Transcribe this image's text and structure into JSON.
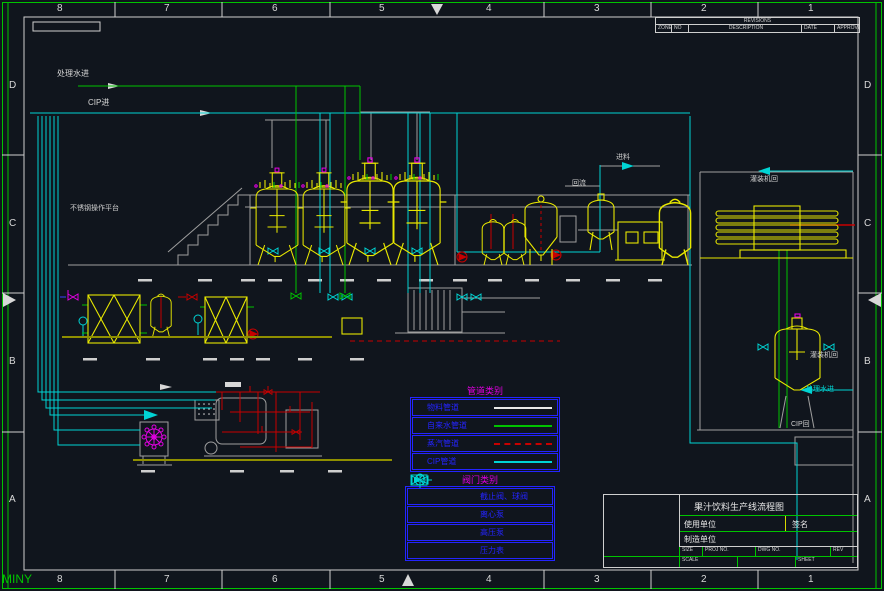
{
  "colors": {
    "background": "#10151d",
    "frame_green": "#00c400",
    "line_white": "#d8d8d8",
    "cip_cyan": "#00d4d4",
    "water_green": "#00c400",
    "steam_red": "#c80000",
    "equipment_yellow": "#e8e800",
    "legend_blue": "#2424ff",
    "accent_magenta": "#e000e0"
  },
  "border": {
    "zones": [
      "8",
      "7",
      "6",
      "5",
      "4",
      "3",
      "2",
      "1"
    ],
    "rows": [
      "D",
      "C",
      "B",
      "A"
    ]
  },
  "revision_table": {
    "title": "REVISIONS",
    "columns": [
      "ZONE",
      "NO",
      "DESCRIPTION",
      "DATE",
      "APPROVED"
    ]
  },
  "labels": {
    "treated_water_in": "处理水进",
    "cip_in": "CIP进",
    "platform_note": "不锈钢操作平台",
    "feed": "进料",
    "return_flow": "回流",
    "filler_return_top": "灌装机回",
    "filler_return_right": "灌装机回",
    "treated_water_right": "处理水进",
    "cip_return": "CIP回",
    "watermark": "MINY"
  },
  "pipe_legend": {
    "title": "管道类别",
    "rows": [
      {
        "label": "物料管道",
        "color": "#e8e8e8",
        "dash": "solid"
      },
      {
        "label": "自来水管道",
        "color": "#00c400",
        "dash": "solid"
      },
      {
        "label": "蒸汽管道",
        "color": "#c80000",
        "dash": "dashed"
      },
      {
        "label": "CIP管道",
        "color": "#00d4d4",
        "dash": "solid"
      }
    ]
  },
  "valve_legend": {
    "title": "阀门类别",
    "rows": [
      {
        "icon": "valve-icon",
        "label": "截止阀、球阀"
      },
      {
        "icon": "centrifugal-pump-icon",
        "label": "离心泵"
      },
      {
        "icon": "high-pressure-pump-icon",
        "label": "高压泵"
      },
      {
        "icon": "pressure-gauge-icon",
        "label": "压力表"
      }
    ]
  },
  "title_block": {
    "title": "果汁饮料生产线流程图",
    "field_user": "使用单位",
    "field_sign": "签名",
    "field_maker": "制造单位",
    "size_label": "SIZE",
    "proj_label": "PROJ NO.",
    "dwg_label": "DWG NO.",
    "rev_label": "REV",
    "scale_label": "SCALE",
    "sheet_label": "SHEET"
  }
}
